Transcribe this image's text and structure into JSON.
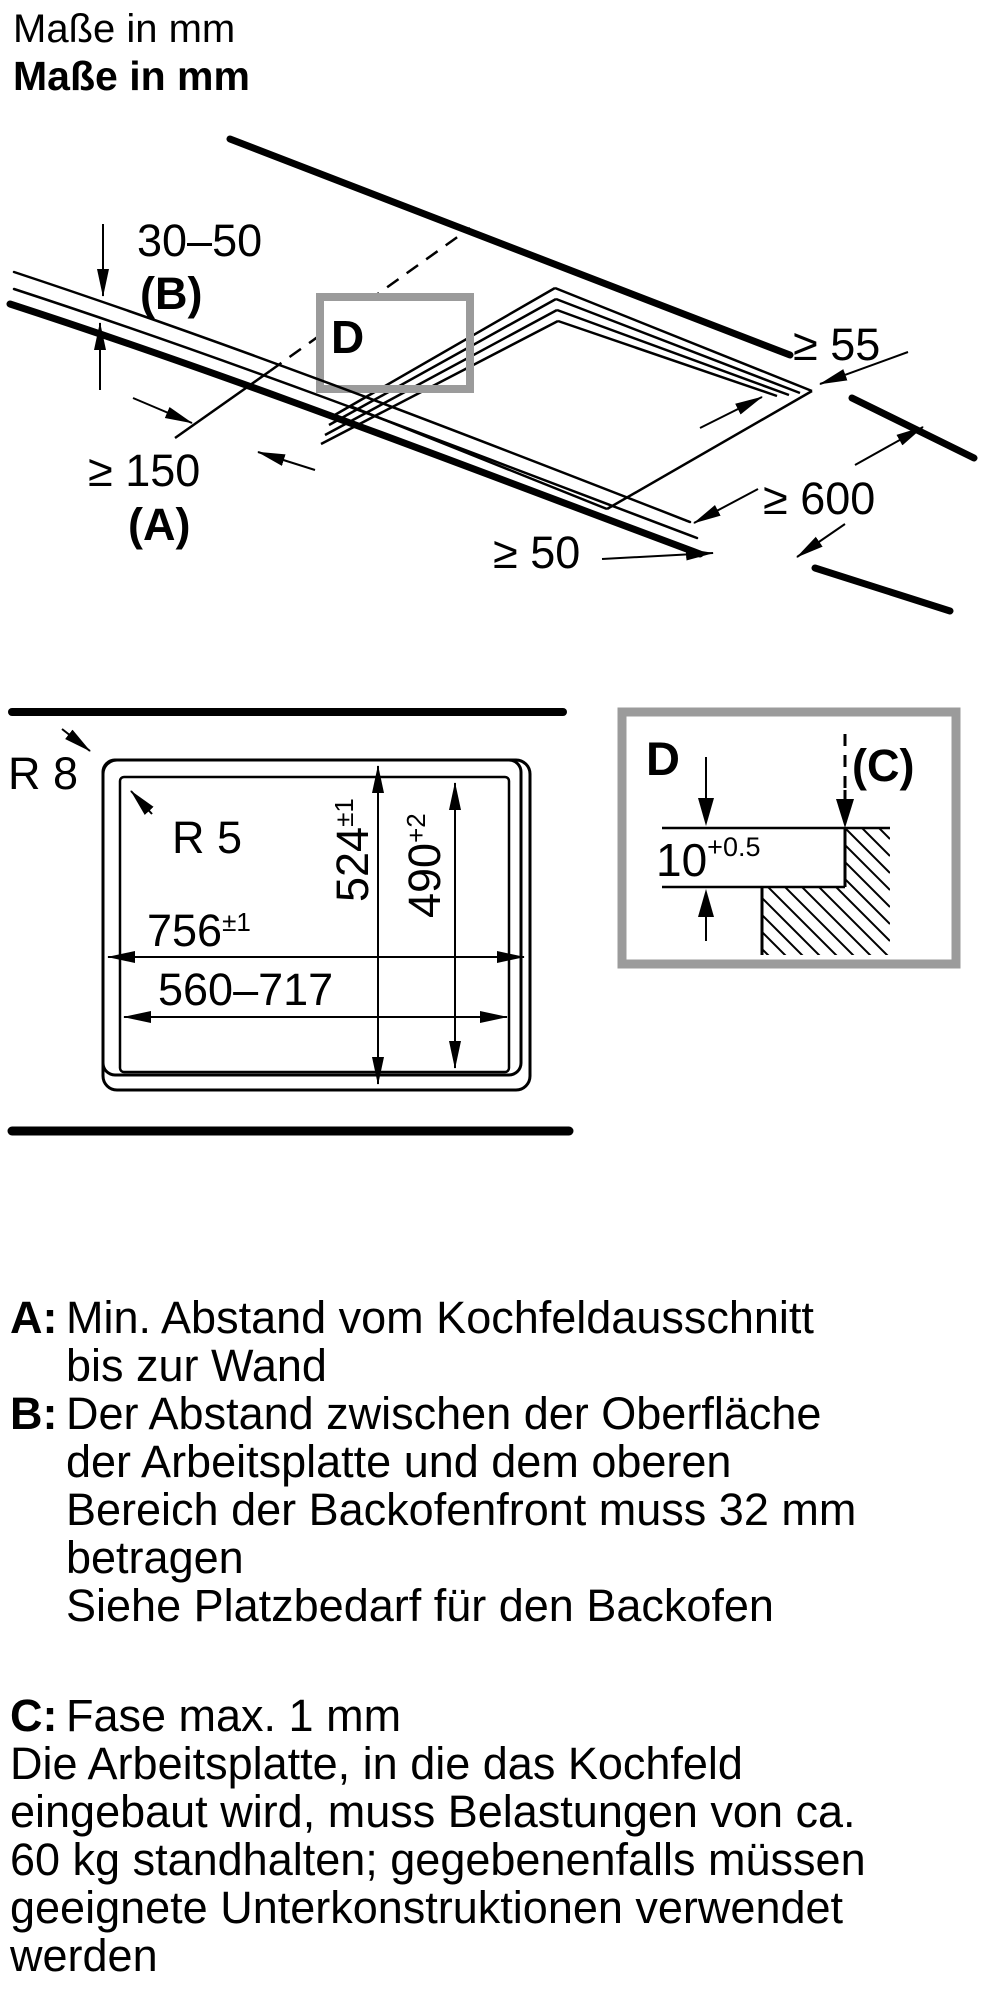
{
  "header": {
    "title_regular": "Maße in mm",
    "title_bold": "Maße in mm"
  },
  "colors": {
    "ink": "#000000",
    "detail_border": "#9b9b9b"
  },
  "perspective": {
    "detail_marker": "D",
    "dim_worktop_oven_gap": "30–50",
    "dim_worktop_oven_key": "(B)",
    "dim_cutout_wall": "≥ 150",
    "dim_cutout_wall_key": "(A)",
    "dim_side_clearance": "≥ 55",
    "dim_worktop_depth": "≥ 600",
    "dim_front_clearance": "≥ 50"
  },
  "cutout": {
    "radius_outer": "R 8",
    "radius_inner": "R 5",
    "appliance_width": "756",
    "appliance_width_tol": "±1",
    "cutout_width_range": "560–717",
    "appliance_depth": "524",
    "appliance_depth_tol": "±1",
    "cutout_depth": "490",
    "cutout_depth_tol": "+2"
  },
  "detail": {
    "marker": "D",
    "chamfer_key": "(C)",
    "step_depth": "10",
    "step_depth_tol": "+0.5"
  },
  "notes": {
    "a": {
      "key": "A:",
      "lines": [
        "Min. Abstand vom Kochfeldausschnitt",
        "bis zur Wand"
      ]
    },
    "b": {
      "key": "B:",
      "lines": [
        "Der Abstand zwischen der Oberfläche",
        "der Arbeitsplatte und dem oberen",
        "Bereich der Backofenfront muss 32 mm",
        "betragen",
        "Siehe Platzbedarf für den Backofen"
      ]
    },
    "c": {
      "key": "C:",
      "lines": [
        "Fase max. 1 mm"
      ]
    },
    "load": {
      "lines": [
        "Die Arbeitsplatte, in die das Kochfeld",
        "eingebaut wird, muss Belastungen von ca.",
        "60 kg standhalten; gegebenenfalls müssen",
        "geeignete Unterkonstruktionen verwendet",
        "werden"
      ]
    }
  }
}
